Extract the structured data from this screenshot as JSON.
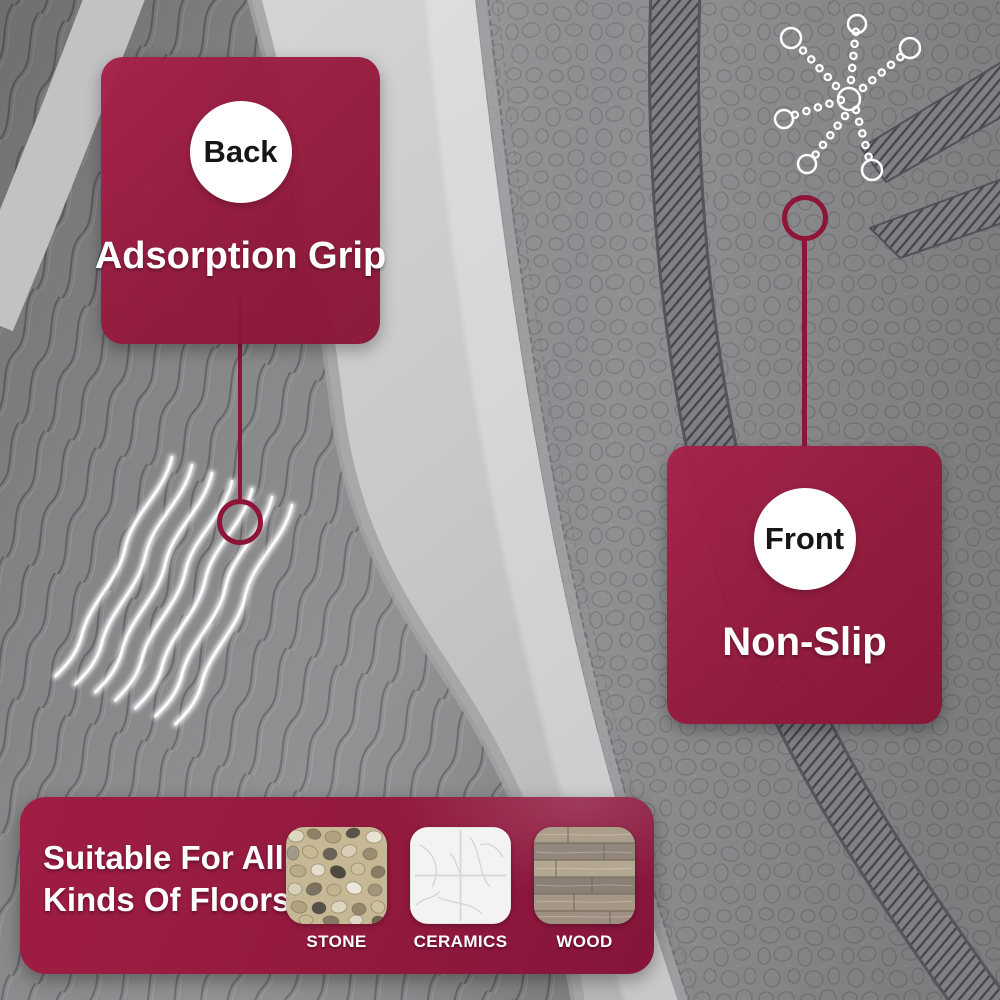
{
  "colors": {
    "accent_maroon": "#961a3e",
    "accent_maroon_dark": "#86143a",
    "accent_maroon_light": "#a6224a",
    "connector_maroon": "#8e1538",
    "badge_text": "#161616",
    "light_text": "#ffffff",
    "floor_gray": "#c9c9cb",
    "back_mat_gray": "#8c8c8f",
    "front_mat_gray": "#909093"
  },
  "callouts": {
    "back": {
      "badge": "Back",
      "label": "Adsorption Grip"
    },
    "front": {
      "badge": "Front",
      "label": "Non-Slip"
    }
  },
  "banner": {
    "heading_lines": [
      "Suitable For All",
      "Kinds Of Floors:"
    ],
    "floors": [
      {
        "label": "STONE",
        "icon": "stone-texture-swatch"
      },
      {
        "label": "CERAMICS",
        "icon": "ceramics-texture-swatch"
      },
      {
        "label": "WOOD",
        "icon": "wood-texture-swatch"
      }
    ]
  },
  "icons": {
    "grip_highlight": "wavy-grip-lines-icon",
    "front_texture_highlight": "pebble-chain-icon",
    "back_target": "target-ring-icon",
    "front_target": "target-ring-icon"
  }
}
